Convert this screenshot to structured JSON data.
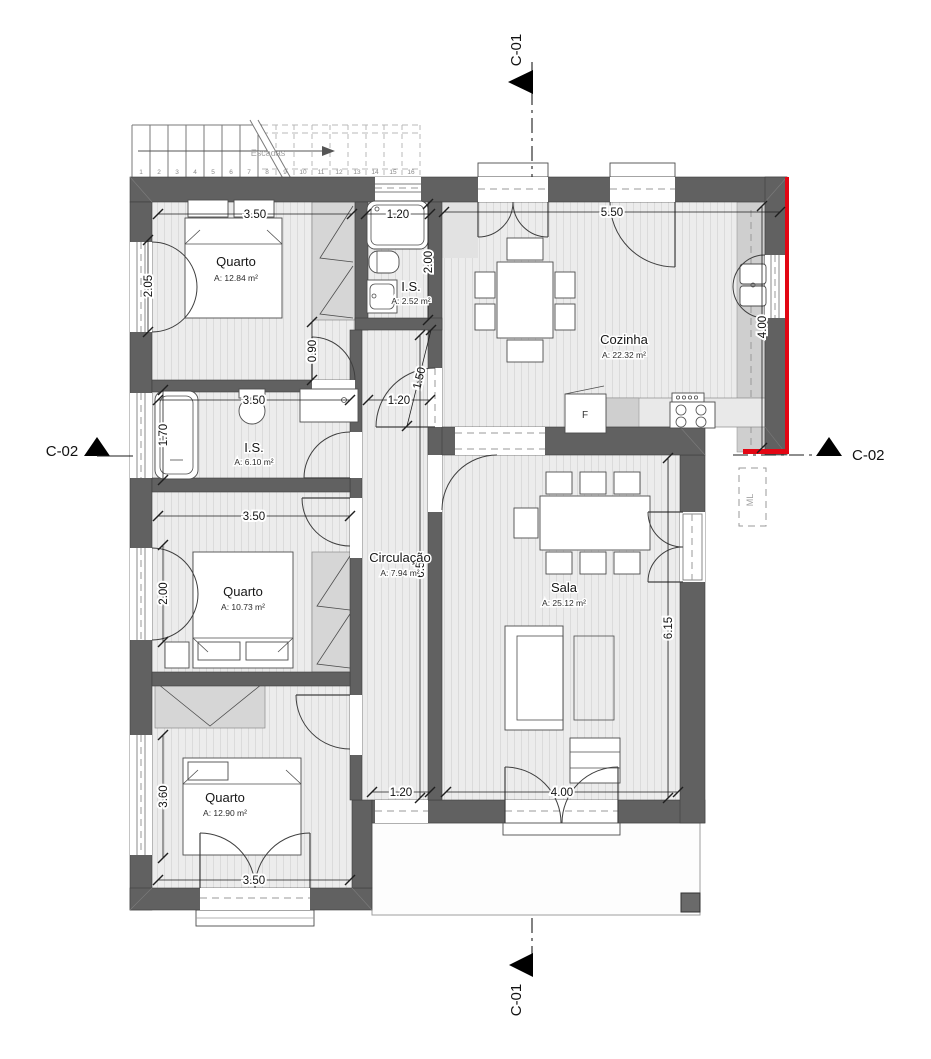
{
  "sections": {
    "top": "C-01",
    "bottom": "C-01",
    "left": "C-02",
    "right": "C-02"
  },
  "rooms": [
    {
      "name": "Quarto",
      "area": "A: 12.84 m²"
    },
    {
      "name": "I.S.",
      "area": "A: 2.52 m²"
    },
    {
      "name": "Cozinha",
      "area": "A: 22.32 m²"
    },
    {
      "name": "I.S.",
      "area": "A: 6.10 m²"
    },
    {
      "name": "Circulação",
      "area": "A: 7.94 m²"
    },
    {
      "name": "Quarto",
      "area": "A: 10.73 m²"
    },
    {
      "name": "Sala",
      "area": "A: 25.12 m²"
    },
    {
      "name": "Quarto",
      "area": "A: 12.90 m²"
    }
  ],
  "labels": {
    "stairs": "Escadas",
    "fridge": "F",
    "washer": "ML"
  },
  "stairs_steps": [
    "1",
    "2",
    "3",
    "4",
    "5",
    "6",
    "7",
    "8",
    "9",
    "10",
    "11",
    "12",
    "13",
    "14",
    "15",
    "16"
  ],
  "dimensions": [
    {
      "v": "3.50",
      "x1": 158,
      "y1": 214,
      "x2": 352,
      "y2": 214
    },
    {
      "v": "1.20",
      "x1": 366,
      "y1": 214,
      "x2": 430,
      "y2": 214
    },
    {
      "v": "5.50",
      "x1": 444,
      "y1": 212,
      "x2": 780,
      "y2": 212
    },
    {
      "v": "2.05",
      "x1": 148,
      "y1": 240,
      "x2": 148,
      "y2": 332,
      "rot": -90
    },
    {
      "v": "2.00",
      "x1": 428,
      "y1": 204,
      "x2": 428,
      "y2": 320,
      "rot": -90
    },
    {
      "v": "0.90",
      "x1": 312,
      "y1": 322,
      "x2": 312,
      "y2": 380,
      "rot": -90
    },
    {
      "v": "1.50",
      "x1": 431,
      "y1": 330,
      "x2": 407,
      "y2": 426,
      "rot": -76
    },
    {
      "v": "4.00",
      "x1": 762,
      "y1": 206,
      "x2": 762,
      "y2": 448,
      "rot": -90
    },
    {
      "v": "3.50",
      "x1": 158,
      "y1": 400,
      "x2": 350,
      "y2": 400
    },
    {
      "v": "1.20",
      "x1": 368,
      "y1": 400,
      "x2": 430,
      "y2": 400
    },
    {
      "v": "1.70",
      "x1": 163,
      "y1": 390,
      "x2": 163,
      "y2": 480,
      "rot": -90
    },
    {
      "v": "3.50",
      "x1": 158,
      "y1": 516,
      "x2": 350,
      "y2": 516
    },
    {
      "v": "2.00",
      "x1": 163,
      "y1": 545,
      "x2": 163,
      "y2": 642,
      "rot": -90
    },
    {
      "v": "6.50",
      "x1": 420,
      "y1": 335,
      "x2": 420,
      "y2": 798,
      "rot": -90
    },
    {
      "v": "6.15",
      "x1": 668,
      "y1": 458,
      "x2": 668,
      "y2": 798,
      "rot": -90
    },
    {
      "v": "3.60",
      "x1": 163,
      "y1": 735,
      "x2": 163,
      "y2": 858,
      "rot": -90
    },
    {
      "v": "1.20",
      "x1": 372,
      "y1": 792,
      "x2": 430,
      "y2": 792
    },
    {
      "v": "4.00",
      "x1": 446,
      "y1": 792,
      "x2": 678,
      "y2": 792
    },
    {
      "v": "3.50",
      "x1": 158,
      "y1": 880,
      "x2": 350,
      "y2": 880
    }
  ],
  "colors": {
    "wall": "#616161",
    "accent_red": "#e30613",
    "floor_bg": "#ececec",
    "floor_stripe": "#dbdbdb",
    "hatch_gray": "#d6d6d6"
  }
}
